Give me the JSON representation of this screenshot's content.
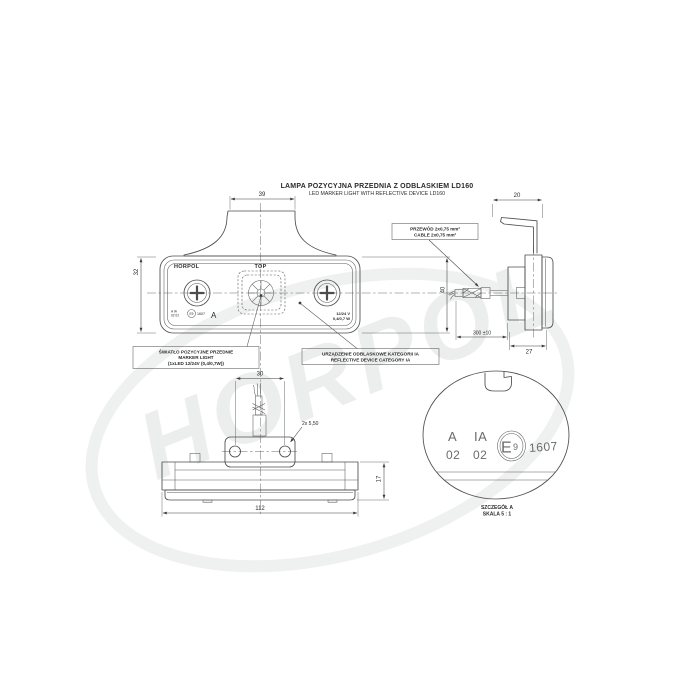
{
  "title": {
    "pl": "LAMPA POZYCYJNA PRZEDNIA Z ODBLASKIEM LD160",
    "en": "LED MARKER LIGHT WITH REFLECTIVE DEVICE LD160"
  },
  "front": {
    "brand": "HORPOL",
    "top": "TOP",
    "mark_row1": "A IA",
    "mark_row2": "02 02",
    "emark": "E9",
    "num": "1607",
    "detail_letter": "A",
    "volt": "12/24 V",
    "watt": "0,4/0,7 W",
    "dim_width": "39",
    "dim_left": "32",
    "dim_right": "40"
  },
  "side": {
    "dim_bracket": "20",
    "dim_cable": "300 ±10",
    "dim_depth": "27"
  },
  "bottom": {
    "dim_holes": "30",
    "holes_note": "2x 5,50",
    "dim_height": "17",
    "dim_width": "112"
  },
  "detail": {
    "a": "A",
    "a_sub": "02",
    "ia": "IA",
    "ia_sub": "02",
    "emark_e": "E",
    "emark_9": "9",
    "num": "1607",
    "cap1": "SZCZEGÓŁ A",
    "cap2": "SKALA 5 : 1"
  },
  "callout_light": {
    "l1": "ŚWIATŁO POZYCYJNE PRZEDNIE",
    "l2": "MARKER LIGHT",
    "l3": "(1xLED 12/24V (0,4/0,7W))"
  },
  "callout_reflex": {
    "l1": "URZĄDZENIE ODBLASKOWE KATEGORII IA",
    "l2": "REFLECTIVE DEVICE CATEGORY IA"
  },
  "callout_cable": {
    "l1": "PRZEWÓD 2x0,75 mm²",
    "l2": "CABLE 2x0,75 mm²"
  },
  "watermark": "HORPOL",
  "colors": {
    "line": "#4d4d4d",
    "dim_text": "#2b2b2b",
    "watermark": "#eceded",
    "background": "#ffffff"
  }
}
